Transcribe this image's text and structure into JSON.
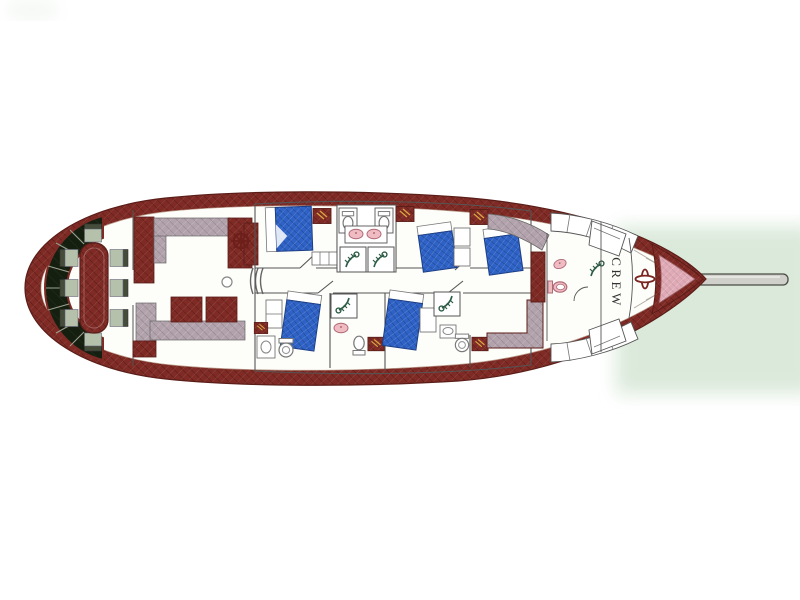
{
  "plan": {
    "crew_label": "CREW",
    "colors": {
      "hull": "#7f2a24",
      "deck": "#fdfdfa",
      "bed": "#2e62c6",
      "sofa_gray": "#b2a2ac",
      "bench_dark": "#151f10",
      "chair": "#b5c1ab",
      "chair_back": "#454d3a",
      "fixture_pink": "#f0bcc4",
      "bow_pink": "#dfaab6",
      "water_green": "#d9e8d9",
      "bowsprit": "#d0d0ca",
      "wall": "#555555"
    },
    "counts": {
      "dining_chairs": 8,
      "guest_double_beds": 5,
      "shower_stalls": 5,
      "toilets": 6,
      "washbasins": 4
    },
    "icons": [
      "helm-wheel",
      "shower-spray",
      "toilet",
      "washbasin",
      "windlass",
      "stairs",
      "bowsprit",
      "ship-hull"
    ]
  }
}
